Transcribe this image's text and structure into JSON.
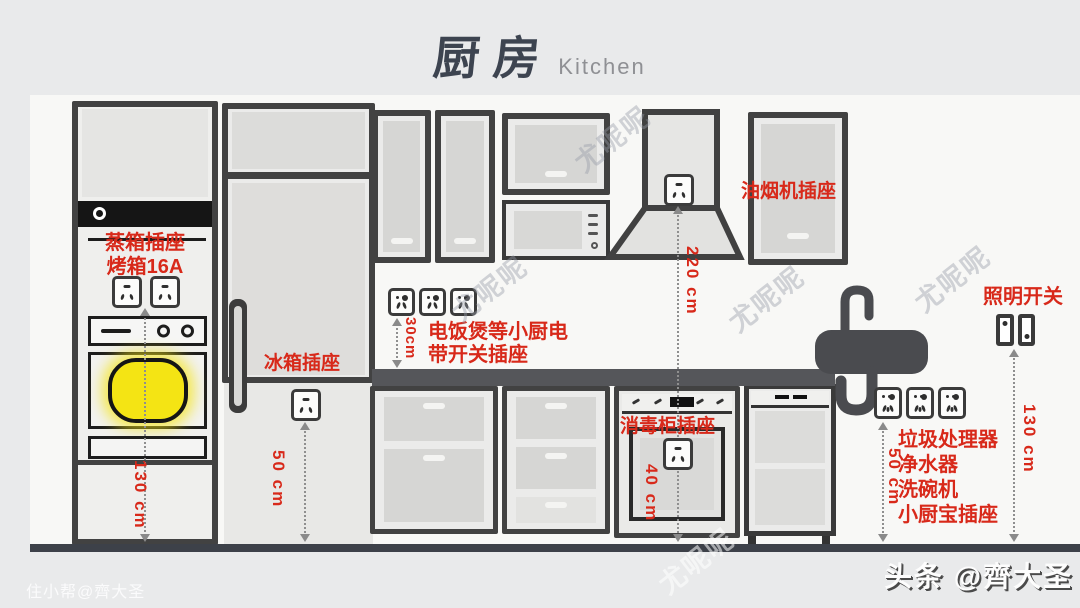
{
  "title": {
    "zh": "厨房",
    "en": "Kitchen"
  },
  "colors": {
    "accent_red": "#d8291a",
    "highlight_yellow": "#f4e414",
    "wall": "#f8f8f6",
    "floor": "#3d4149"
  },
  "labels": {
    "steam_oven_outlet": "蒸箱插座",
    "oven_16a": "烤箱16A",
    "fridge_outlet": "冰箱插座",
    "small_appliances_line1": "电饭煲等小厨电",
    "small_appliances_line2": "带开关插座",
    "hood_outlet": "油烟机插座",
    "light_switch": "照明开关",
    "sterilizer_outlet": "消毒柜插座",
    "under_sink_lines": [
      "垃圾处理器",
      "净水器",
      "洗碗机",
      "小厨宝插座"
    ]
  },
  "measurements": {
    "oven_column": "130 cm",
    "fridge": "50 cm",
    "countertop_sockets": "30cm",
    "hood": "220 cm",
    "sterilizer": "40 cm",
    "under_sink": "50 cm",
    "light_switch": "130 cm"
  },
  "watermark": "尤呢呢",
  "credits": {
    "bottom_left": "住小帮@齊大圣",
    "bottom_right": "头条 @齊大圣"
  }
}
